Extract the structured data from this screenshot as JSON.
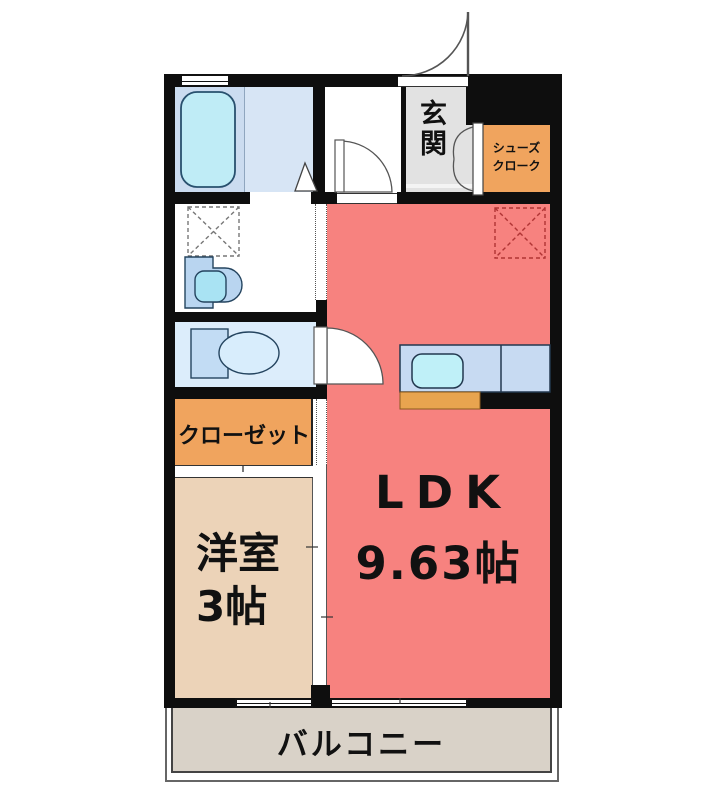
{
  "floorplan": {
    "type": "apartment-floor-plan",
    "rooms": {
      "genkan": {
        "label": "玄関"
      },
      "shoe_cloak": {
        "lines": [
          "シューズ",
          "クローク"
        ]
      },
      "closet": {
        "label": "クローゼット"
      },
      "western_room": {
        "name": "洋室",
        "size": "3帖"
      },
      "ldk": {
        "name": "LDK",
        "size": "9.63帖"
      },
      "balcony": {
        "label": "バルコニー"
      }
    },
    "fixtures": [
      "bathtub",
      "washing-machine-space",
      "washbasin",
      "toilet",
      "kitchen-counter",
      "kitchen-sink",
      "refrigerator-space",
      "entry-door",
      "hall-door",
      "toilet-door",
      "bathroom-folding-door",
      "shoe-cloak-doors",
      "sliding-windows",
      "sliding-partitions"
    ],
    "colors": {
      "wall": "#0E0E0E",
      "ldk_floor": "#F7827F",
      "western_room_floor": "#ECD3B8",
      "storage_orange": "#F0A45E",
      "genkan_floor": "#E2E2E2",
      "balcony_floor": "#D9D2C8",
      "bathroom_floor": "#D7E5F5",
      "bathroom_left_panel": "#CBDCF0",
      "toilet_floor": "#DCEDFB",
      "bathtub": "#BFECF6",
      "washbasin_cabinet": "#B9D5F0",
      "kitchen_counter": "#C7DAF2",
      "kitchen_sink": "#BFF0F8",
      "kitchen_base": "#E8A44F",
      "refrigerator_dash": "#B03434"
    }
  }
}
